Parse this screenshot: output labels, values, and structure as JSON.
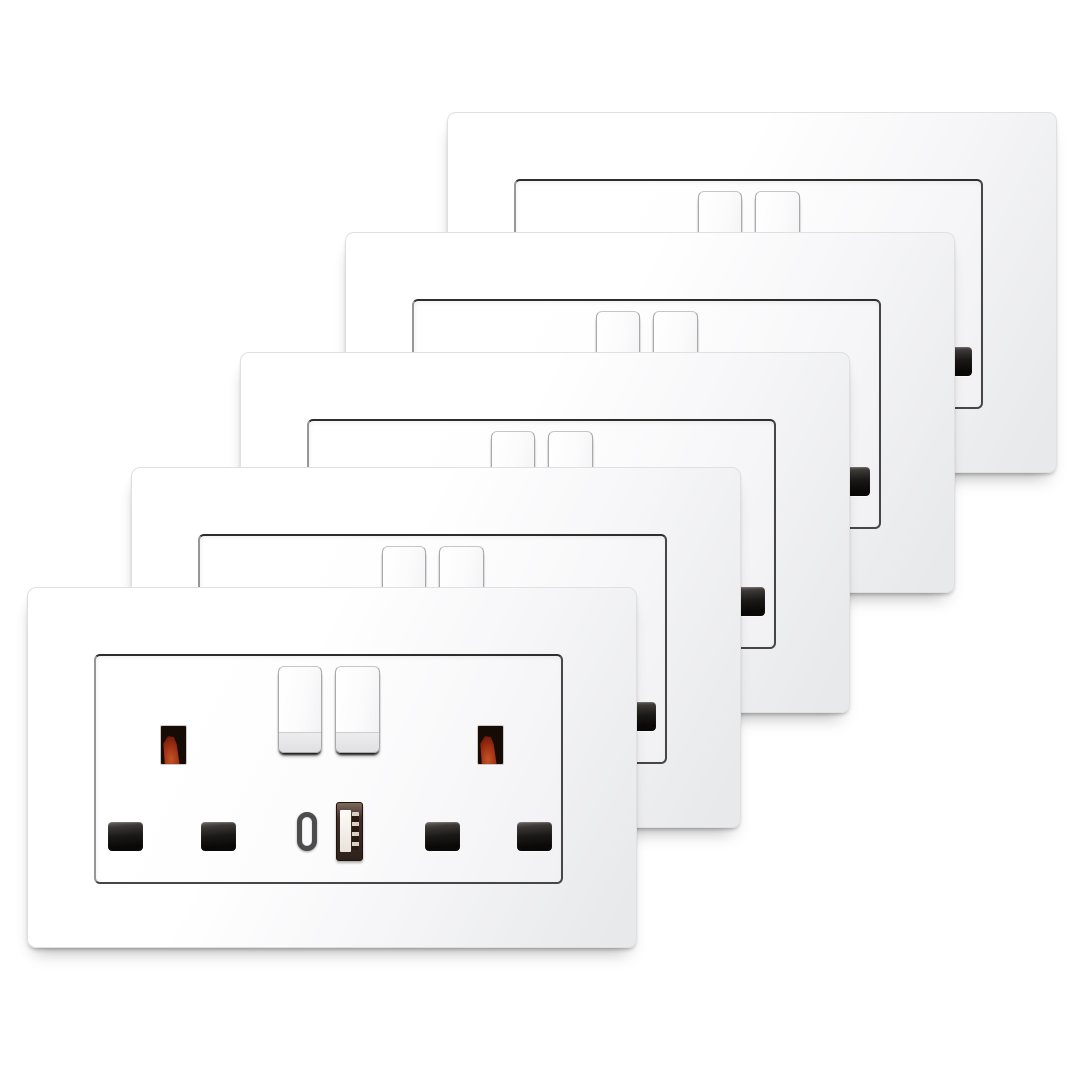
{
  "scene": {
    "type": "product-photo",
    "subject": "Five identical white UK 13A double switched socket faceplates with red neon indicators, two rocker switches, USB-C and USB-A charging ports, stacked diagonally from top-right (back) to bottom-left (front) on a white background",
    "background_color": "#ffffff",
    "plate_count": 5
  },
  "plate_spec": {
    "width_px": 610,
    "height_px": 361,
    "gangs": 2,
    "rocker_switches": 2,
    "neon_indicators": 2,
    "pin_holes": 4,
    "ports": [
      "usb-c",
      "usb-a"
    ]
  },
  "plates": [
    {
      "name": "faceplate-5-back",
      "x": 447,
      "y": 112
    },
    {
      "name": "faceplate-4",
      "x": 345,
      "y": 232
    },
    {
      "name": "faceplate-3",
      "x": 240,
      "y": 352
    },
    {
      "name": "faceplate-2",
      "x": 131,
      "y": 467
    },
    {
      "name": "faceplate-1-front",
      "x": 27,
      "y": 587
    }
  ],
  "colors": {
    "background": "#ffffff",
    "plate_top": "#ffffff",
    "plate_mid": "#f6f6f8",
    "plate_bottom": "#e8e9eb",
    "plate_edge": "#e0e0e3",
    "frame_dark": "#2d2d2b",
    "frame_mid": "#46464a",
    "frame_light": "#97979a",
    "switch_outline": "#a9a9ab",
    "switch_band": "#ededef",
    "switch_edge_dark": "#151515",
    "neon_bezel": "#c9c9c9",
    "neon_body": "#170b06",
    "neon_glow": "#9a2c11",
    "neon_glow_bright": "#c25527",
    "hole_dark": "#0a0908",
    "hole_highlight": "#6a6662",
    "usb_a_frame": "#41302a",
    "usb_a_tongue": "#fdfbf8",
    "usb_c_ring": "#4c4c4e",
    "usb_c_slot": "#fafafa"
  }
}
